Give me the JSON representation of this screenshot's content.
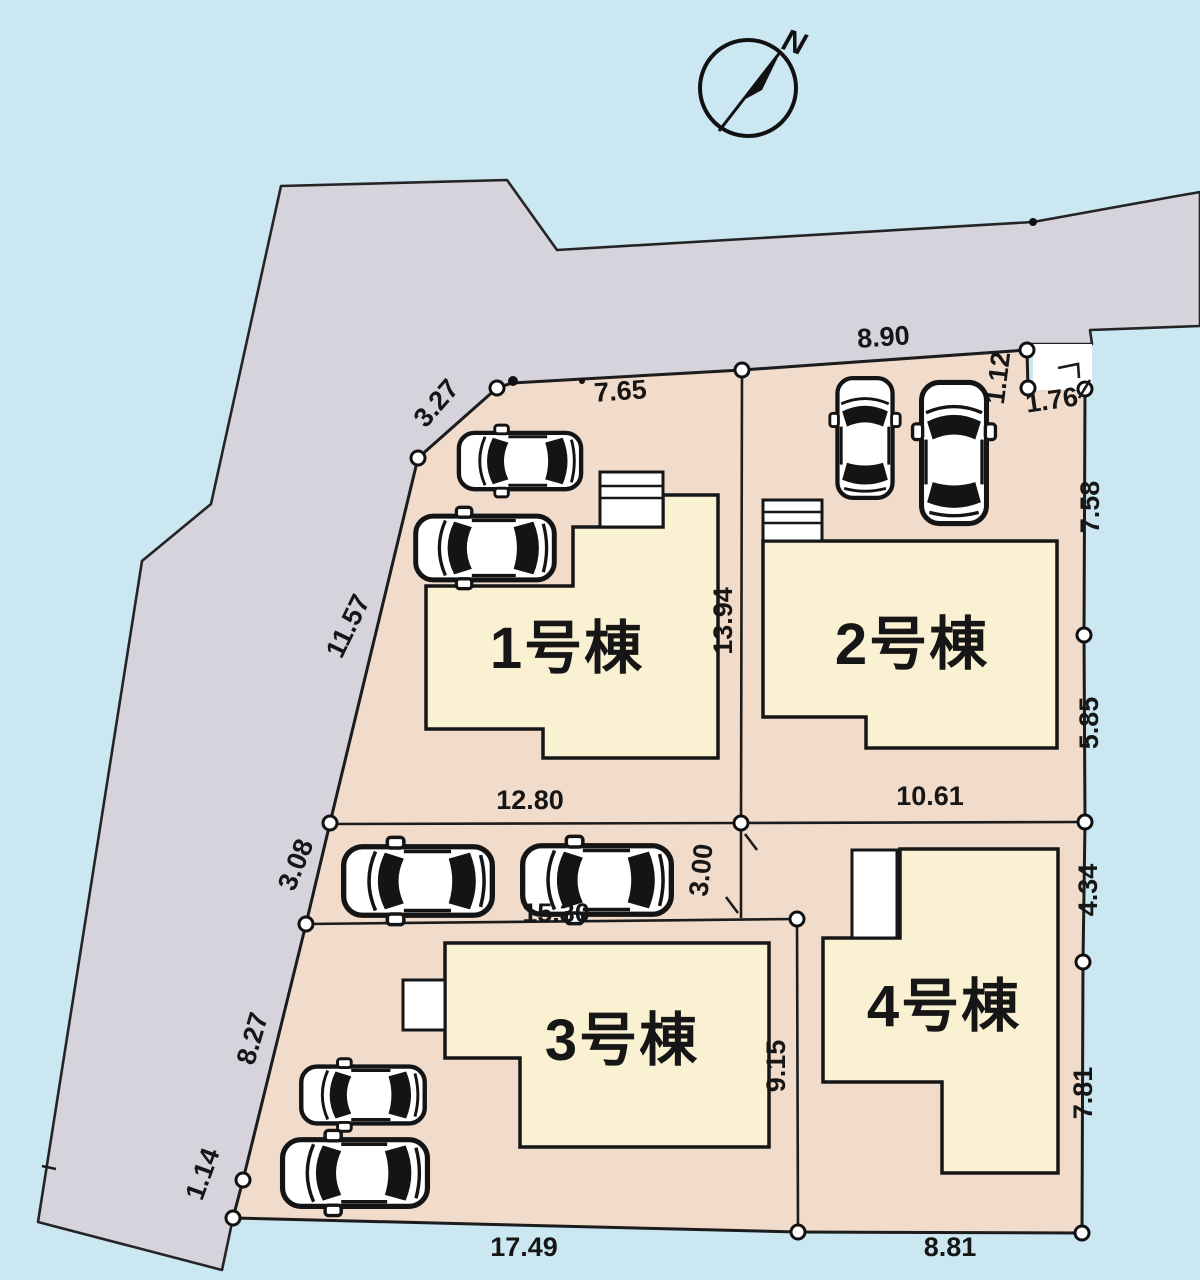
{
  "plan": {
    "type": "residential-site-plan",
    "units": "meters"
  },
  "colors": {
    "sky": "#cbe7f2",
    "road": "#d6d3dc",
    "lot": "#f1dbca",
    "building": "#faf0d2",
    "line": "#1c1c1c",
    "white": "#ffffff"
  },
  "compass": {
    "north_label": "N"
  },
  "buildings": [
    {
      "label": "1号棟"
    },
    {
      "label": "2号棟"
    },
    {
      "label": "3号棟"
    },
    {
      "label": "4号棟"
    }
  ],
  "dimensions": {
    "lot1": {
      "northwest": "3.27",
      "north": "7.65",
      "west": "11.57",
      "east": "13.94",
      "south": "12.80"
    },
    "lot2": {
      "north": "8.90",
      "notch_east": "1.12",
      "notch_south": "1.76",
      "east_upper": "7.58",
      "east_lower": "5.85",
      "south": "10.61"
    },
    "lot3": {
      "west": "3.08",
      "north": "15.30",
      "east": "9.15",
      "southwest": "8.27",
      "west_bottom": "1.14",
      "south": "17.49"
    },
    "lot4": {
      "west": "3.00",
      "east_upper": "4.34",
      "east_lower": "7.81",
      "south": "8.81"
    }
  }
}
